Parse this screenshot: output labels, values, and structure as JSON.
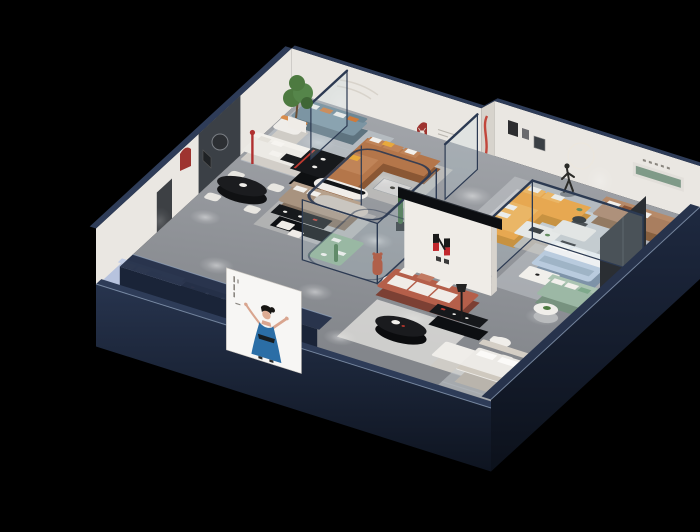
{
  "meta": {
    "title": "3D isometric cutaway render of a furniture showroom floor plan",
    "render_style": "dollhouse axonometric on black background"
  },
  "colors": {
    "background": "#000000",
    "wall_navy_top": "#2e3c58",
    "wall_navy_face": "#1c2638",
    "wall_navy_dark": "#10151f",
    "edge_highlight": "#93a5bf",
    "wall_white": "#eae7e2",
    "accent_wall_dark": "#3b4046",
    "floor_gray": "#94979c",
    "floor_light": "#b8bbbf",
    "rug_light": "#d2d6da",
    "arch_red": "#9e3430",
    "lamp_red": "#b03030",
    "stripe_red": "#c0392f",
    "sofa_orange": "#f29c2a",
    "sofa_caramel": "#b4764a",
    "sofa_tan": "#a97e5f",
    "sofa_terracotta": "#b55f4a",
    "sofa_sage": "#9cb8a5",
    "sofa_periwinkle": "#b7c3de",
    "sofa_bluegray": "#7c95a3",
    "sofa_taupe": "#a8937f",
    "bed_blue": "#b9cbde",
    "pillow_white": "#f2f0ec",
    "pillow_yellow": "#e8a93c",
    "pillow_orange": "#cf7a3a",
    "console_black": "#16181b",
    "table_black": "#1a1b1e",
    "logo_red": "#c1272d",
    "logo_black": "#1a1a1a",
    "poster_bg": "#f7f6f4",
    "poster_dress": "#2b6ea6",
    "skin": "#d9a58f",
    "hair_black": "#171513",
    "plant_green": "#4d7a40",
    "cactus_green": "#3e6b40",
    "niche_green": "#7f9a88",
    "cube_teal": "#7f99a4",
    "bear_terracotta": "#b0604a",
    "glass_fill": "rgba(190,215,225,0.22)",
    "glass_frame": "#2c3a52"
  },
  "scene": {
    "type": "isometric-dollhouse",
    "subject": "furniture showroom",
    "vignettes": [
      "lounge-with-tree",
      "dining-set",
      "caramel-l-sofa-room",
      "orange-l-sofa-room",
      "tan-sofa-wall",
      "glass-bedroom",
      "sage-sofa-corner",
      "taupe-sofa-corridor",
      "terracotta-sofa-logo-room",
      "south-bedroom",
      "periwinkle-sofa-room",
      "plant-atrium"
    ],
    "poster": {
      "subject": "illustrated woman in blue dress, arms raised, on white lightbox"
    },
    "brand_logo": {
      "style": "two-bar red and black mark with small characters below"
    },
    "sculptures": [
      "walking-figure-with-ring",
      "teddy-bear-terracotta",
      "deer-head-in-red-arch"
    ]
  }
}
